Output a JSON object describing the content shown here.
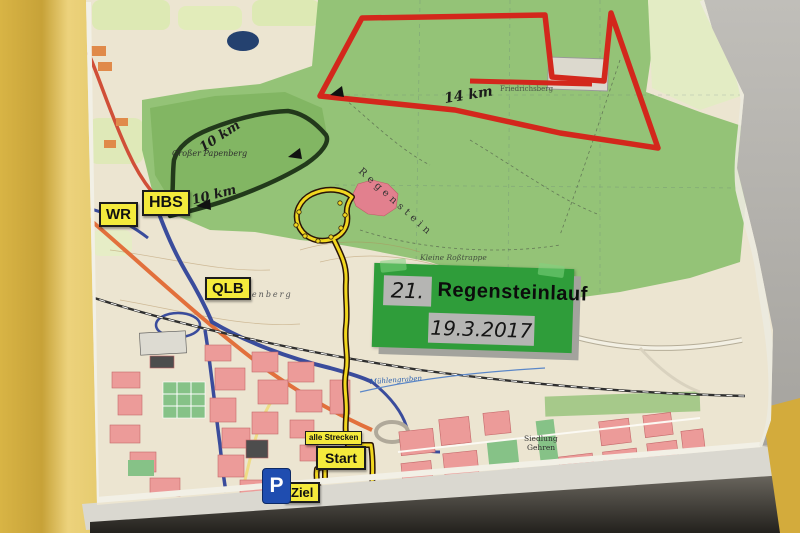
{
  "event_sign": {
    "race_number": "21.",
    "race_name": "Regensteinlauf",
    "race_date": "19.3.2017"
  },
  "map_labels": {
    "wr": "WR",
    "hbs": "HBS",
    "qlb": "QLB",
    "start": "Start",
    "ziel": "Ziel",
    "alle_strecken": "alle Strecken",
    "parking": "P"
  },
  "routes": [
    {
      "id": "red-14km",
      "label": "14 km",
      "color": "#d3271c"
    },
    {
      "id": "dark-10km",
      "label": "10 km",
      "label_with_arrow": "← 10 km",
      "color": "#22391b"
    },
    {
      "id": "yellow-all",
      "label": "alle Strecken",
      "color": "#f1d71f"
    }
  ],
  "place_names": {
    "grosser_papenberg": "Großer Papenberg",
    "regenstein": "Regenstein",
    "platenberg": "Platenberg",
    "friedrichsberg": "Friedrichsberg",
    "kleine_rosstrappe": "Kleine Roßtrappe",
    "siedlung": "Siedlung",
    "gehren": "Gehren",
    "muehlengraben": "Mühlengraben"
  },
  "colors": {
    "wall_yellow": "#d6b242",
    "wall_gray": "#b6b4af",
    "sign_green": "#2f9d3a",
    "label_yellow": "#f4ea3c",
    "parking_blue": "#1f4db0",
    "route_red": "#d3271c",
    "route_dark": "#22391b",
    "route_yellow": "#f1d71f",
    "forest_green": "#94c377",
    "town_pink": "#ec9b99"
  }
}
